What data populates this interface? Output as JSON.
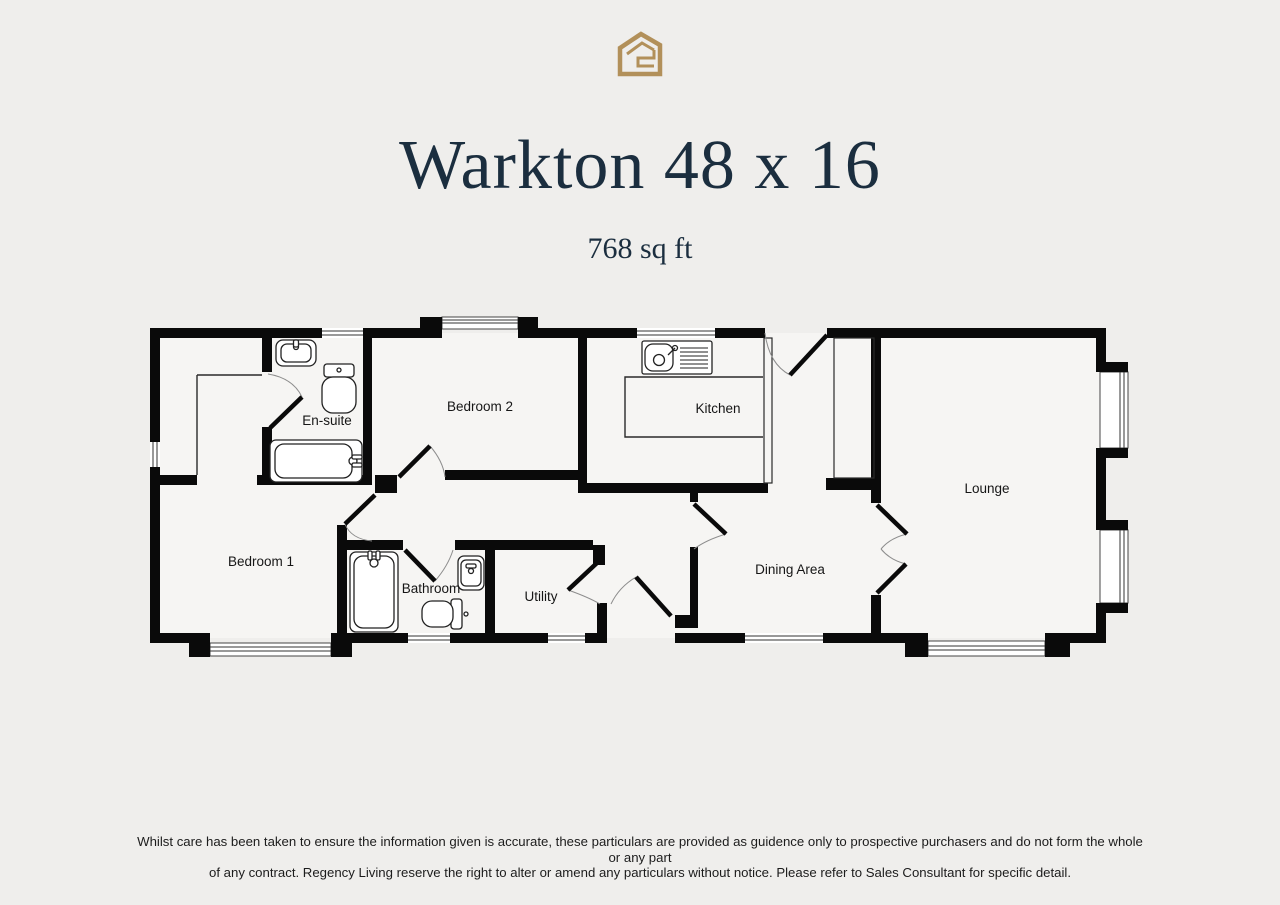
{
  "brand": {
    "logo_icon": "house-logo-icon",
    "logo_color": "#b2905a"
  },
  "header": {
    "title": "Warkton 48 x 16",
    "area": "768 sq ft",
    "title_color": "#1b2e3f"
  },
  "floorplan": {
    "wall_color": "#0a0a0a",
    "interior_color": "#f6f5f3",
    "background_color": "#efeeec",
    "rooms": [
      {
        "id": "ensuite",
        "label": "En-suite"
      },
      {
        "id": "bedroom2",
        "label": "Bedroom 2"
      },
      {
        "id": "kitchen",
        "label": "Kitchen"
      },
      {
        "id": "lounge",
        "label": "Lounge"
      },
      {
        "id": "bedroom1",
        "label": "Bedroom 1"
      },
      {
        "id": "bathroom",
        "label": "Bathroom"
      },
      {
        "id": "utility",
        "label": "Utility"
      },
      {
        "id": "dining",
        "label": "Dining Area"
      }
    ]
  },
  "footer": {
    "disclaimer_line1": "Whilst care has been taken to ensure the information given is accurate, these particulars are provided as guidence only to prospective purchasers and do not form the whole or any part",
    "disclaimer_line2": "of any contract. Regency Living reserve the right to alter or amend any particulars without notice. Please refer to Sales Consultant for specific detail."
  }
}
